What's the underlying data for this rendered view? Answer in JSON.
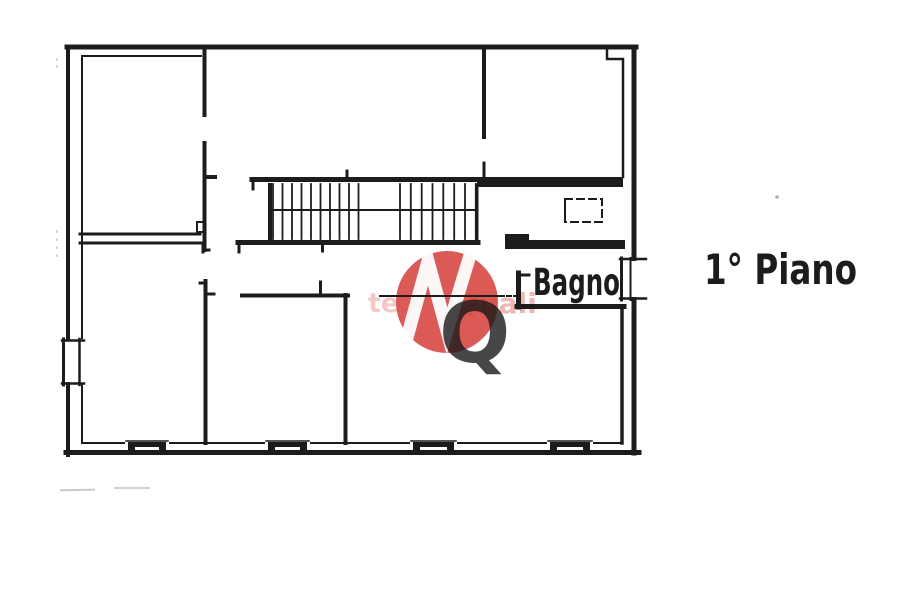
{
  "document": {
    "kind": "scanned floor plan"
  },
  "labels": {
    "bathroom": "Bagno",
    "floor": "1° Piano"
  },
  "watermark": {
    "letter": "Q",
    "left_fragment": "te",
    "right_fragment": "Quali",
    "circle_color": "#d6423c",
    "mark_color": "#ffffff",
    "letter_color": "#1a1a1a"
  },
  "colors": {
    "background": "#ffffff",
    "ink": "#1c1c1c"
  }
}
